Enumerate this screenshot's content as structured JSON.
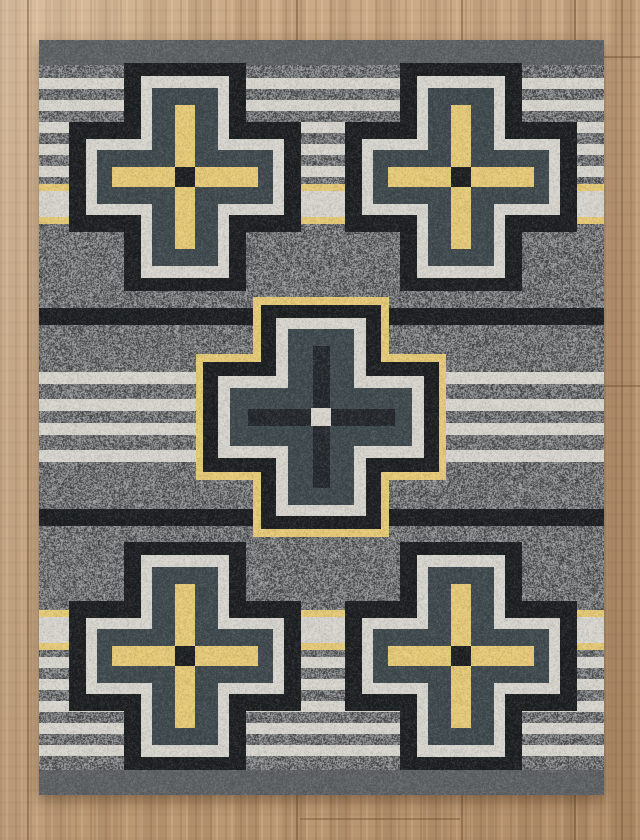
{
  "scene": {
    "description": "Photo of a southwestern style area rug with five stepped crosses lying on a wood plank floor",
    "floor": {
      "base_color": "#c2a07c",
      "seam_color": "#684a2e",
      "vertical_seams_x": [
        27,
        296,
        461,
        574,
        621
      ],
      "horizontal_seams": [
        {
          "y": 56,
          "x1": 604,
          "x2": 640
        },
        {
          "y": 385,
          "x1": 604,
          "x2": 640
        },
        {
          "y": 818,
          "x1": 300,
          "x2": 460
        }
      ]
    },
    "rug": {
      "description": "Gray heathered rug with horizontal cream, gold and black stripes, solid gray end bands, four corner stepped crosses (black, cream, slate layers with gold inner plus and black center) and one center stepped cross with gold outline and dark inner plus with cream center",
      "x": 39,
      "y": 40,
      "width": 565,
      "height": 755,
      "colors": {
        "field": "#717476",
        "band": "#5d6164",
        "cream": "#d8d6cf",
        "yellow": "#e6cb77",
        "black": "#1c1f21",
        "slate": "#3f4a4e",
        "plusdark": "#24282c"
      },
      "stripes": [
        {
          "y": 0,
          "h": 25,
          "c": "band"
        },
        {
          "y": 38,
          "h": 11,
          "c": "cream"
        },
        {
          "y": 60,
          "h": 11,
          "c": "cream"
        },
        {
          "y": 82,
          "h": 11,
          "c": "cream"
        },
        {
          "y": 104,
          "h": 11,
          "c": "cream"
        },
        {
          "y": 126,
          "h": 11,
          "c": "cream"
        },
        {
          "y": 144,
          "h": 7,
          "c": "yellow"
        },
        {
          "y": 151,
          "h": 26,
          "c": "cream"
        },
        {
          "y": 177,
          "h": 7,
          "c": "yellow"
        },
        {
          "y": 268,
          "h": 17,
          "c": "black"
        },
        {
          "y": 332,
          "h": 12,
          "c": "cream"
        },
        {
          "y": 359,
          "h": 12,
          "c": "cream"
        },
        {
          "y": 383,
          "h": 12,
          "c": "cream"
        },
        {
          "y": 410,
          "h": 12,
          "c": "cream"
        },
        {
          "y": 469,
          "h": 17,
          "c": "black"
        },
        {
          "y": 570,
          "h": 7,
          "c": "yellow"
        },
        {
          "y": 577,
          "h": 26,
          "c": "cream"
        },
        {
          "y": 603,
          "h": 7,
          "c": "yellow"
        },
        {
          "y": 617,
          "h": 11,
          "c": "cream"
        },
        {
          "y": 639,
          "h": 11,
          "c": "cream"
        },
        {
          "y": 661,
          "h": 11,
          "c": "cream"
        },
        {
          "y": 683,
          "h": 11,
          "c": "cream"
        },
        {
          "y": 705,
          "h": 11,
          "c": "cream"
        },
        {
          "y": 730,
          "h": 25,
          "c": "band"
        }
      ],
      "crosses": [
        {
          "name": "top-left",
          "cx": 146,
          "cy": 137,
          "type": "corner"
        },
        {
          "name": "top-right",
          "cx": 422,
          "cy": 137,
          "type": "corner"
        },
        {
          "name": "center",
          "cx": 282,
          "cy": 377,
          "type": "center"
        },
        {
          "name": "bottom-left",
          "cx": 146,
          "cy": 616,
          "type": "corner"
        },
        {
          "name": "bottom-right",
          "cx": 422,
          "cy": 616,
          "type": "corner"
        }
      ],
      "cross_specs": {
        "corner": {
          "layers": [
            {
              "c": "black",
              "vw": 122,
              "vh": 228,
              "hw": 232,
              "hh": 110
            },
            {
              "c": "cream",
              "vw": 88,
              "vh": 202,
              "hw": 198,
              "hh": 76
            },
            {
              "c": "slate",
              "vw": 66,
              "vh": 178,
              "hw": 176,
              "hh": 54
            },
            {
              "c": "yellow",
              "vw": 20,
              "vh": 144,
              "hw": 146,
              "hh": 20
            }
          ],
          "core": {
            "w": 20,
            "h": 20,
            "c": "black"
          }
        },
        "center": {
          "layers": [
            {
              "c": "yellow",
              "vw": 136,
              "vh": 240,
              "hw": 250,
              "hh": 126
            },
            {
              "c": "black",
              "vw": 120,
              "vh": 224,
              "hw": 236,
              "hh": 110
            },
            {
              "c": "cream",
              "vw": 90,
              "vh": 198,
              "hw": 206,
              "hh": 82
            },
            {
              "c": "slate",
              "vw": 66,
              "vh": 176,
              "hw": 182,
              "hh": 58
            },
            {
              "c": "plusdark",
              "vw": 17,
              "vh": 142,
              "hw": 147,
              "hh": 17
            }
          ],
          "core": {
            "w": 20,
            "h": 18,
            "c": "cream"
          }
        }
      }
    }
  }
}
